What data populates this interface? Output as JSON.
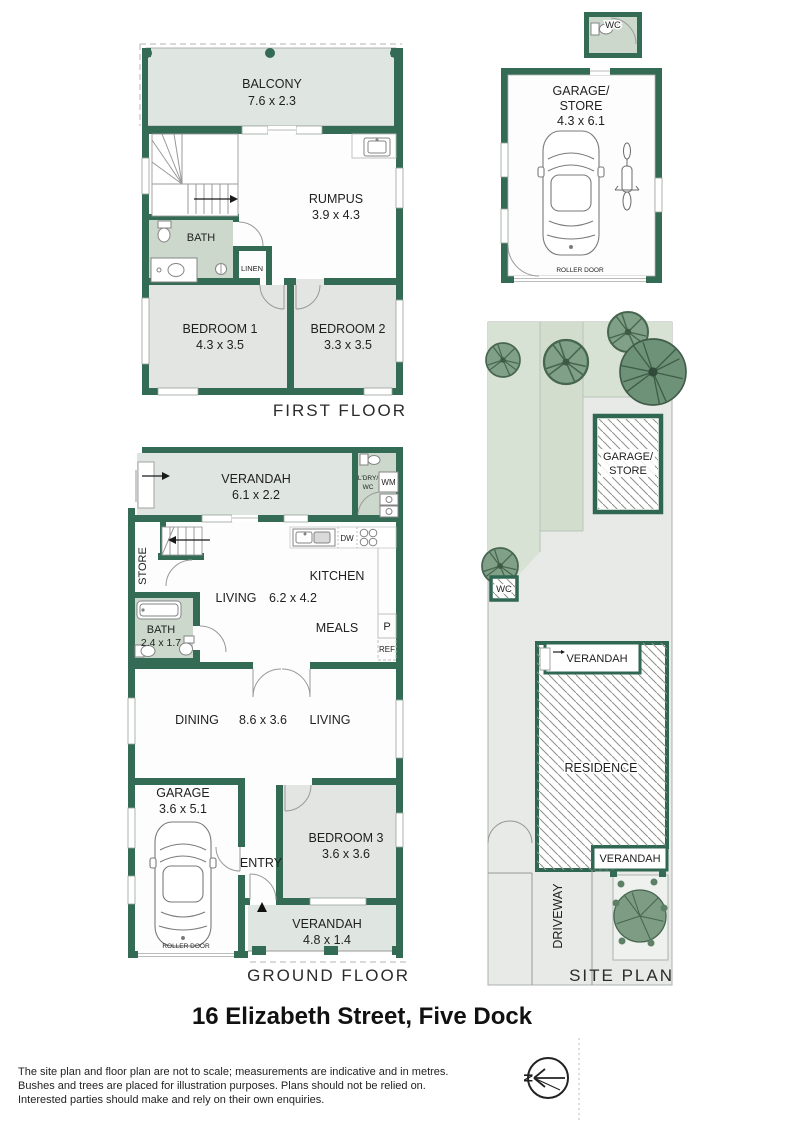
{
  "title": "16 Elizabeth Street, Five Dock",
  "disclaimer": [
    "The site plan and floor plan are not to scale; measurements are indicative and in metres.",
    "Bushes and trees are placed for illustration purposes. Plans should not be relied on.",
    "Interested parties should make and rely on their own enquiries."
  ],
  "compass": {
    "north": "N"
  },
  "colors": {
    "wall_green": "#336b54",
    "tint_green": "#ccd8cc",
    "verandah_grey_green": "#dfe5e0",
    "room_grey": "#e3e5e3",
    "lawn_green": "#d8e2d4",
    "tree_green": "#7e9c84",
    "paved_grey": "#e8eae7"
  },
  "first_floor": {
    "floor_label": "FIRST FLOOR",
    "balcony": {
      "name": "BALCONY",
      "dims": "7.6 x 2.3"
    },
    "rumpus": {
      "name": "RUMPUS",
      "dims": "3.9 x 4.3"
    },
    "bath": {
      "name": "BATH"
    },
    "linen": {
      "name": "LINEN"
    },
    "bedroom1": {
      "name": "BEDROOM 1",
      "dims": "4.3 x 3.5"
    },
    "bedroom2": {
      "name": "BEDROOM 2",
      "dims": "3.3 x 3.5"
    }
  },
  "outbuilding": {
    "wc": {
      "name": "WC"
    },
    "garage_store": {
      "name_line1": "GARAGE/",
      "name_line2": "STORE",
      "dims": "4.3 x 6.1",
      "roller_door": "ROLLER DOOR"
    }
  },
  "ground_floor": {
    "floor_label": "GROUND FLOOR",
    "verandah_front": {
      "name": "VERANDAH",
      "dims": "6.1 x 2.2"
    },
    "laundry": {
      "name_line1": "L'DRY/",
      "name_line2": "WC",
      "washing_machine": "WM"
    },
    "store": {
      "name": "STORE"
    },
    "kitchen": {
      "name": "KITCHEN",
      "dishwasher": "DW",
      "pantry": "P",
      "fridge": "REF"
    },
    "living": {
      "name": "LIVING",
      "dims": "6.2 x 4.2"
    },
    "meals": {
      "name": "MEALS"
    },
    "bath": {
      "name": "BATH",
      "dims": "2.4 x 1.7"
    },
    "dining": {
      "name": "DINING",
      "dims": "8.6 x 3.6"
    },
    "living_rear": {
      "name": "LIVING"
    },
    "garage": {
      "name": "GARAGE",
      "dims": "3.6 x 5.1",
      "roller_door": "ROLLER DOOR"
    },
    "entry": {
      "name": "ENTRY"
    },
    "bedroom3": {
      "name": "BEDROOM 3",
      "dims": "3.6 x 3.6"
    },
    "verandah_rear": {
      "name": "VERANDAH",
      "dims": "4.8 x 1.4"
    }
  },
  "site_plan": {
    "plan_label": "SITE PLAN",
    "garage_store": {
      "name_line1": "GARAGE/",
      "name_line2": "STORE"
    },
    "wc": {
      "name": "WC"
    },
    "verandah_front": {
      "name": "VERANDAH"
    },
    "residence": {
      "name": "RESIDENCE"
    },
    "verandah_rear": {
      "name": "VERANDAH"
    },
    "driveway": {
      "name": "DRIVEWAY"
    }
  }
}
